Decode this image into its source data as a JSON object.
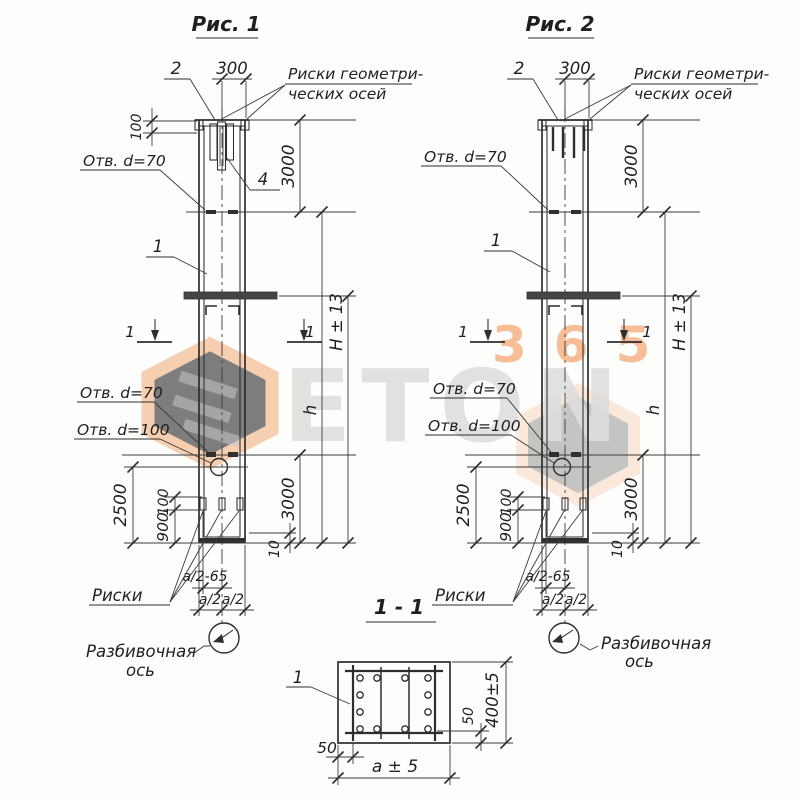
{
  "watermark": {
    "brand_word": "ETON",
    "brand_digits": "365",
    "orange": "#f1a267",
    "gray": "#dedede"
  },
  "fig1": {
    "title": "Рис. 1",
    "pos2": "2",
    "dim_300": "300",
    "risks_axes_1": "Риски геометри-",
    "risks_axes_2": "ческих осей",
    "dim_100_top": "100",
    "hole_70_top": "Отв. d=70",
    "dim_3000_top": "3000",
    "pos1": "1",
    "pos4": "4",
    "cut_label": "1",
    "dim_H": "H ± 13",
    "dim_h": "h",
    "hole_70_bottom": "Отв. d=70",
    "hole_100": "Отв. d=100",
    "dim_2500": "2500",
    "dim_100_bottom": "100",
    "dim_900": "900",
    "dim_3000_bottom": "3000",
    "dim_10": "10",
    "risks": "Риски",
    "dim_a2_65": "а/2-65",
    "dim_a2": "а/2",
    "axis_label_1": "Разбивочная",
    "axis_label_2": "ось"
  },
  "fig2": {
    "title": "Рис. 2",
    "pos2": "2",
    "dim_300": "300",
    "risks_axes_1": "Риски геометри-",
    "risks_axes_2": "ческих осей",
    "hole_70_top": "Отв. d=70",
    "dim_3000_top": "3000",
    "pos1": "1",
    "cut_label": "1",
    "dim_H": "H ± 13",
    "dim_h": "h",
    "hole_70_bottom": "Отв. d=70",
    "hole_100": "Отв. d=100",
    "dim_2500": "2500",
    "dim_100_bottom": "100",
    "dim_900": "900",
    "dim_3000_bottom": "3000",
    "dim_10": "10",
    "risks": "Риски",
    "dim_a2_65": "а/2-65",
    "dim_a2": "а/2",
    "axis_label_1": "Разбивочная",
    "axis_label_2": "ось"
  },
  "section": {
    "title": "1 - 1",
    "pos1": "1",
    "dim_50_left": "50",
    "dim_50_right": "50",
    "dim_400": "400±5",
    "dim_a": "а ± 5"
  }
}
